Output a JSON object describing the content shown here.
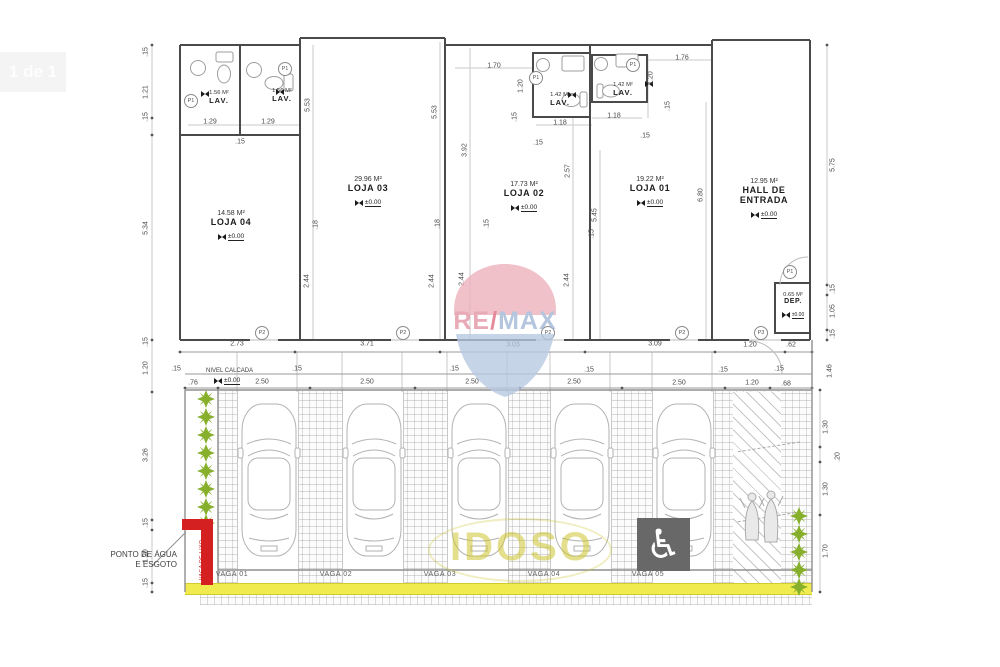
{
  "badge": {
    "label": "1 de 1"
  },
  "watermark": {
    "re": "RE",
    "slash": "/",
    "max": "MAX"
  },
  "rooms": {
    "loja04": {
      "area": "14.58 M²",
      "name": "LOJA 04",
      "level": "±0.00"
    },
    "loja03": {
      "area": "29.96 M²",
      "name": "LOJA 03",
      "level": "±0.00"
    },
    "loja02": {
      "area": "17.73 M²",
      "name": "LOJA 02",
      "level": "±0.00"
    },
    "loja01": {
      "area": "19.22 M²",
      "name": "LOJA 01",
      "level": "±0.00"
    },
    "hall": {
      "area": "12.95 M²",
      "name1": "HALL DE",
      "name2": "ENTRADA",
      "level": "±0.00"
    },
    "dep": {
      "area": "0.65 M²",
      "name": "DEP.",
      "level": "±0.00"
    }
  },
  "lavs": {
    "l4a": {
      "area": "1.56 M²",
      "name": "LAV."
    },
    "l4b": {
      "area": "1.56 M²",
      "name": "LAV."
    },
    "l2": {
      "area": "1.42 M²",
      "name": "LAV."
    },
    "l1": {
      "area": "1.42 M²",
      "name": "LAV."
    }
  },
  "doors": {
    "p1": "P1",
    "p2": "P2",
    "p3": "P3"
  },
  "dims": {
    "left": [
      ".15",
      "1.21",
      ".15",
      "5.34",
      ".15",
      "1.20",
      "3.26",
      ".15",
      "1.20",
      ".15"
    ],
    "right": [
      "5.75",
      ".15",
      "1.05",
      ".15",
      "1.46",
      "1.30",
      ".20",
      "1.30",
      "1.70"
    ],
    "lav4": [
      "1.29",
      "1.29",
      ".15"
    ],
    "lav2": [
      "1.70",
      "1.20",
      ".15",
      "1.18",
      ".15"
    ],
    "lav1": [
      "1.76",
      "1.20",
      "1.18",
      ".15",
      ".15"
    ],
    "vert": [
      "5.53",
      "5.53",
      "3.92",
      "2.57",
      "5.45",
      "6.80",
      "2.44",
      "2.44",
      "2.44",
      "2.44",
      ".18",
      ".18",
      ".15",
      ".15"
    ],
    "row1": [
      "2.73",
      "3.71",
      "3.03",
      "3.09",
      "1.20",
      ".62"
    ],
    "row2": [
      ".15",
      ".15",
      ".15",
      ".15",
      ".15",
      ".15"
    ],
    "row3": [
      ".76",
      "2.50",
      "2.50",
      "2.50",
      "2.50",
      "2.50",
      "1.20",
      ".68"
    ]
  },
  "parking": {
    "vagas": [
      "VAGA 01",
      "VAGA 02",
      "VAGA 03",
      "VAGA 04",
      "VAGA 05"
    ],
    "idoso": "IDOSO",
    "handicap": "♿"
  },
  "notes": {
    "ponto1": "PONTO DE ÁGUA",
    "ponto2": "E ESGOTO",
    "nivel": "NIVEL CALCADA",
    "nivel_level": "±0.00",
    "red_note": "VAGA DE LIXO"
  }
}
